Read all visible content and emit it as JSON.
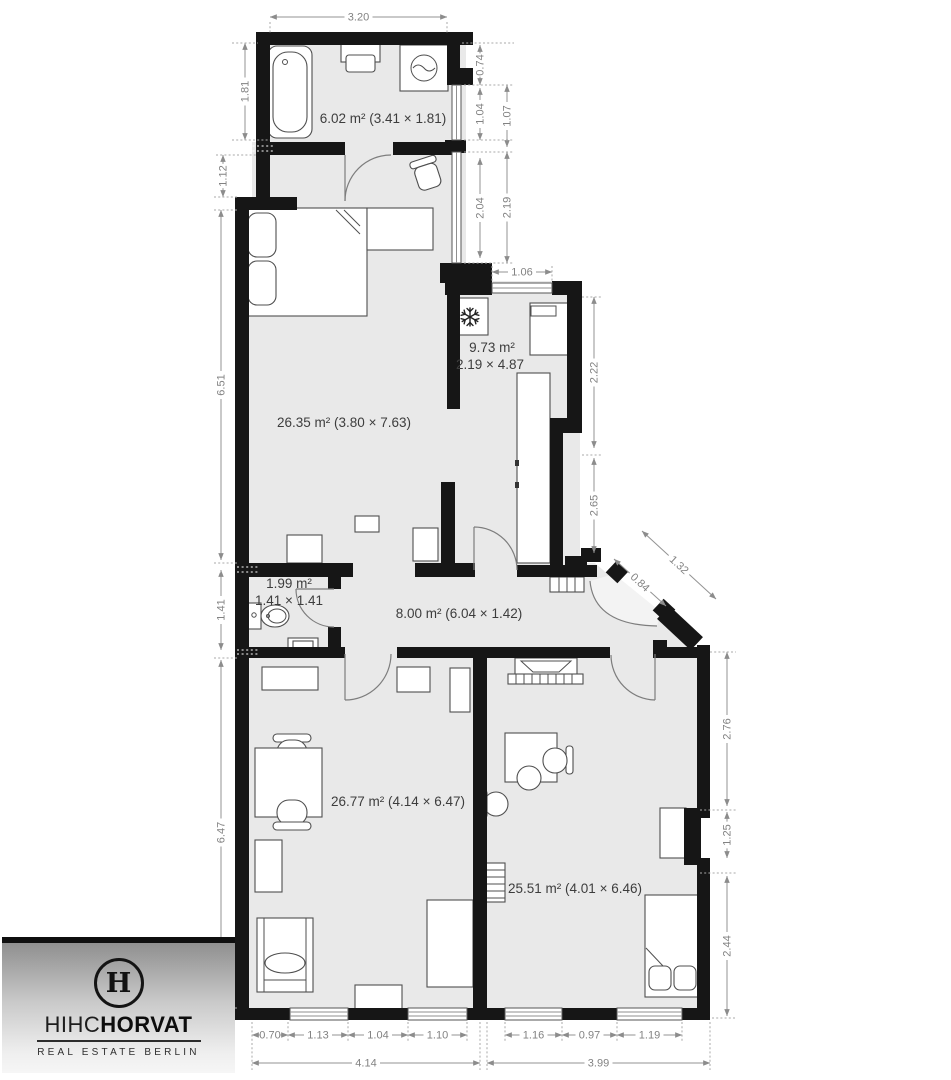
{
  "brand": {
    "monogram": "H",
    "name_light": "HIHC",
    "name_bold": "HORVAT",
    "tagline": "REAL ESTATE BERLIN"
  },
  "plan": {
    "rooms": {
      "bathroom": {
        "label": "6.02 m² (3.41 × 1.81)"
      },
      "bedroom": {
        "label": "26.35 m² (3.80 × 7.63)"
      },
      "kitchen": {
        "area": "9.73 m²",
        "size": "2.19 × 4.87"
      },
      "wc": {
        "area": "1.99 m²",
        "size": "1.41 × 1.41"
      },
      "hallway": {
        "label": "8.00 m² (6.04 × 1.42)"
      },
      "living_room": {
        "label": "26.77 m² (4.14 × 6.47)"
      },
      "bedroom2": {
        "label": "25.51 m² (4.01 × 6.46)"
      }
    },
    "dims": {
      "top_width": "3.20",
      "left": {
        "bath": "1.81",
        "step": "1.12",
        "bedroom": "6.51",
        "wc": "1.41",
        "living": "6.47"
      },
      "right_top": {
        "wall": "0.74",
        "win1_inner": "1.04",
        "win1_outer": "1.07",
        "win2_inner": "2.04",
        "win2_outer": "2.19"
      },
      "kitchen_window": "1.06",
      "kitchen_right": {
        "upper": "2.22",
        "lower": "2.65"
      },
      "entry": {
        "outer": "1.32",
        "door": "0.84"
      },
      "right_bottom": {
        "upper": "2.76",
        "niche": "1.25",
        "lower": "2.44"
      },
      "bottom_left": {
        "s1": "0.70",
        "s2": "1.13",
        "s3": "1.04",
        "s4": "1.10",
        "total": "4.14"
      },
      "bottom_right": {
        "s1": "1.16",
        "s2": "0.97",
        "s3": "1.19",
        "total": "3.99"
      }
    },
    "colors": {
      "wall": "#161616",
      "floor": "#e9e9e9",
      "dimension": "#8c8c8c",
      "label": "#3d3d3d"
    }
  }
}
